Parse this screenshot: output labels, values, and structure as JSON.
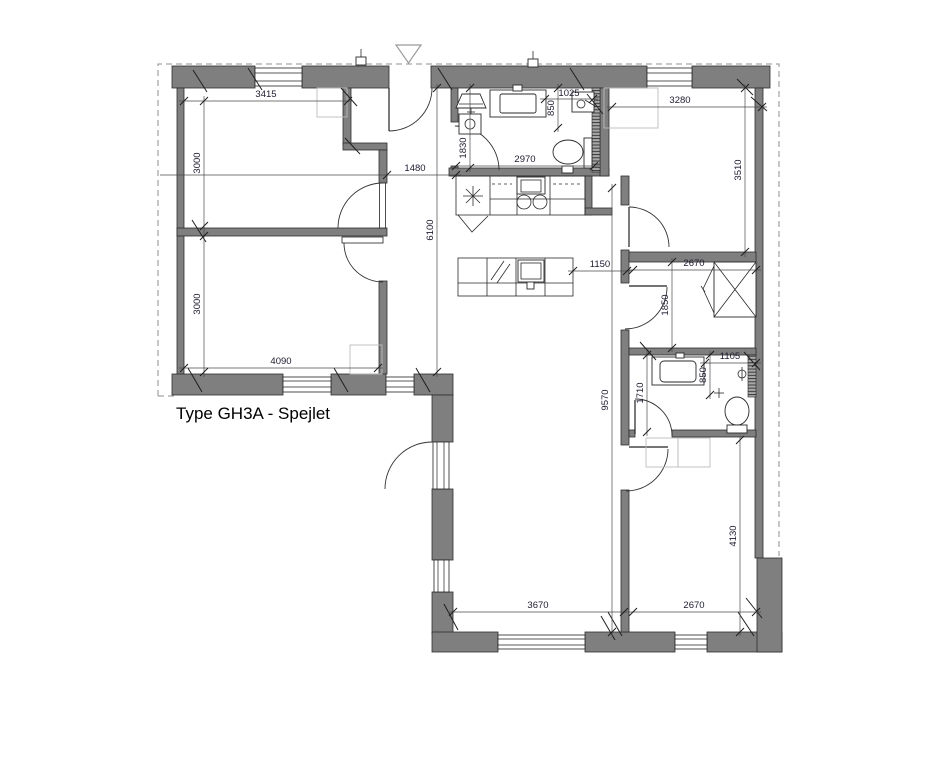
{
  "title": {
    "text": "Type GH3A - Spejlet"
  },
  "colors": {
    "wall": "#7f7f7f",
    "dim_line": "#4a4a4a",
    "dim_text": "#1c1c30",
    "hint": "#bdbdbd",
    "dash": "#8f8f8f"
  },
  "dims": {
    "w3415": "3415",
    "h3000a": "3000",
    "w4090": "4090",
    "h3000b": "3000",
    "w1480": "1480",
    "h6100": "6100",
    "h1830": "1830",
    "w2970": "2970",
    "w1025": "1025",
    "h850a": "850",
    "w3280": "3280",
    "h3510": "3510",
    "w2670a": "2670",
    "h1850": "1850",
    "w1150": "1150",
    "w1105": "1105",
    "h850b": "850",
    "h1710": "1710",
    "h9570": "9570",
    "h4130": "4130",
    "w3670": "3670",
    "w2670b": "2670"
  }
}
